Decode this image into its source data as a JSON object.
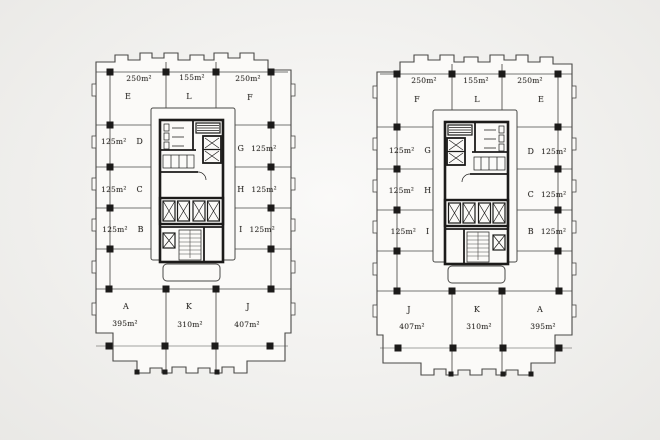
{
  "page": {
    "description": "Scanned office tower floor plans, two mirrored units"
  },
  "colors": {
    "paper": "#f4f3f0",
    "plan_fill": "#fbfaf8",
    "line": "#4a4947",
    "ink": "#1c1b1a",
    "text": "#2e2c29"
  },
  "plans": {
    "left": {
      "top": [
        {
          "area": "250m²",
          "unit": "E"
        },
        {
          "area": "155m²",
          "unit": "L"
        },
        {
          "area": "250m²",
          "unit": "F"
        }
      ],
      "west": [
        {
          "area": "125m²",
          "unit": "D"
        },
        {
          "area": "125m²",
          "unit": "C"
        },
        {
          "area": "125m²",
          "unit": "B"
        }
      ],
      "east": [
        {
          "unit": "G",
          "area": "125m²"
        },
        {
          "unit": "H",
          "area": "125m²"
        },
        {
          "unit": "I",
          "area": "125m²"
        }
      ],
      "bottom": [
        {
          "unit": "A",
          "area": "395m²"
        },
        {
          "unit": "K",
          "area": "310m²"
        },
        {
          "unit": "J",
          "area": "407m²"
        }
      ]
    },
    "right": {
      "top": [
        {
          "area": "250m²",
          "unit": "F"
        },
        {
          "area": "155m²",
          "unit": "L"
        },
        {
          "area": "250m²",
          "unit": "E"
        }
      ],
      "west": [
        {
          "area": "125m²",
          "unit": "G"
        },
        {
          "area": "125m²",
          "unit": "H"
        },
        {
          "area": "125m²",
          "unit": "I"
        }
      ],
      "east": [
        {
          "unit": "D",
          "area": "125m²"
        },
        {
          "unit": "C",
          "area": "125m²"
        },
        {
          "unit": "B",
          "area": "125m²"
        }
      ],
      "bottom": [
        {
          "unit": "J",
          "area": "407m²"
        },
        {
          "unit": "K",
          "area": "310m²"
        },
        {
          "unit": "A",
          "area": "395m²"
        }
      ]
    }
  }
}
